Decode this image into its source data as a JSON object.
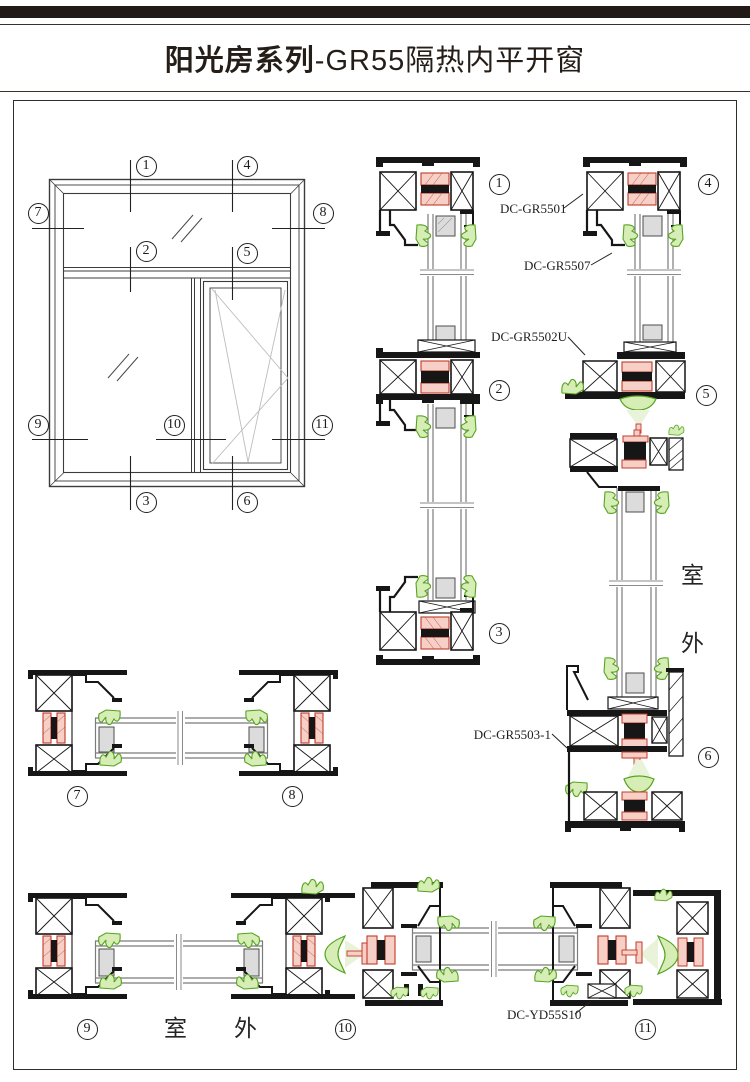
{
  "header": {
    "series": "阳光房系列",
    "model": "-GR55隔热内平开窗"
  },
  "markers": [
    "1",
    "2",
    "3",
    "4",
    "5",
    "6",
    "7",
    "8",
    "9",
    "10",
    "11"
  ],
  "part_labels": {
    "head_frame": "DC-GR5501",
    "sash_profile": "DC-GR5507",
    "mid_rail": "DC-GR5502U",
    "bottom_rail": "DC-GR5503-1",
    "drain_part": "DC-YD55S10"
  },
  "annotations": {
    "outdoor_char1": "室",
    "outdoor_char2": "外"
  },
  "colors": {
    "profile_line": "#161616",
    "thermal_break_red": "#c23b28",
    "gasket_green": "#56a41f",
    "glass_gray": "#7b7b7b"
  }
}
